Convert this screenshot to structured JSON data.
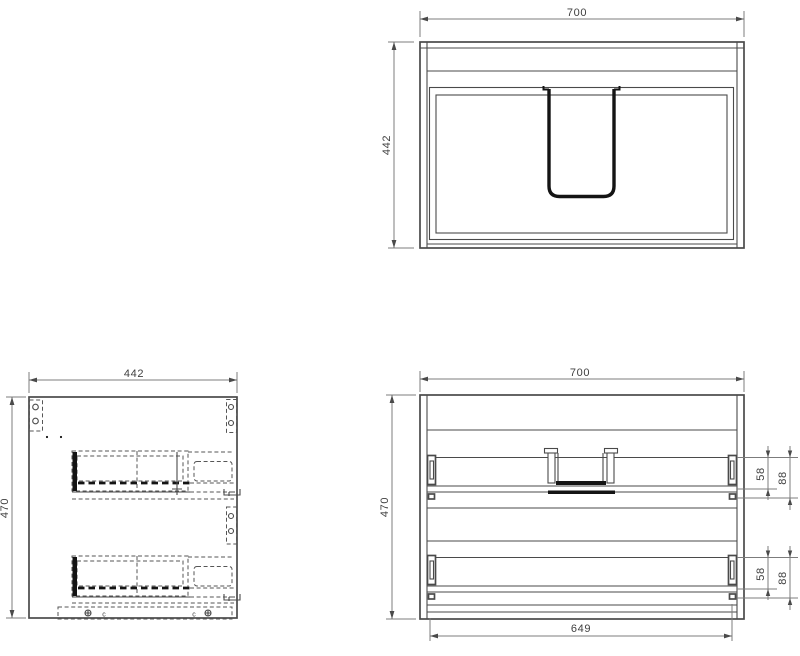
{
  "drawing": {
    "background": "#ffffff",
    "line_colors": {
      "object": "#4a4a4a",
      "dimension": "#7c7c7c",
      "heavy": "#141414",
      "text": "#3f3f3f"
    },
    "front_view": {
      "width": "700",
      "height": "442"
    },
    "side_view": {
      "width": "442",
      "height": "470",
      "clip_marks": [
        "c",
        "c"
      ]
    },
    "carcass_view": {
      "width": "700",
      "height": "470",
      "bottom_width": "649",
      "top_drawer": {
        "slide_offset": "58",
        "slide_clearance": "88"
      },
      "bottom_drawer": {
        "slide_offset": "58",
        "slide_clearance": "88"
      }
    }
  }
}
